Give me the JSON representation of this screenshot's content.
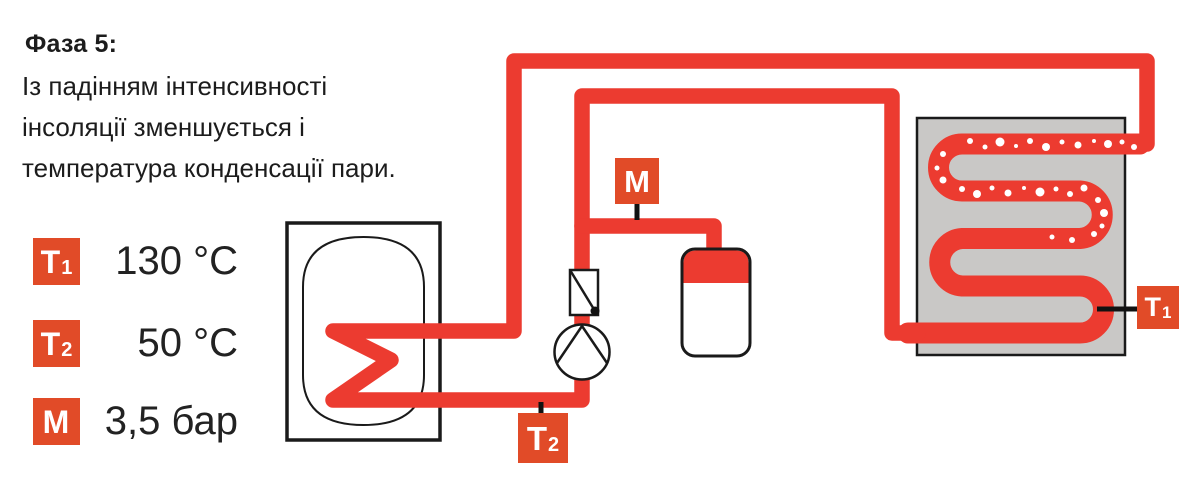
{
  "colors": {
    "pipe_red": "#EC3B30",
    "badge_red": "#E14B28",
    "collector_gray": "#C9C8C6",
    "outline_black": "#1A1A1A",
    "text_black": "#1C1C1C",
    "bubble_white": "#FFFFFF"
  },
  "phase": {
    "title": "Фаза 5:",
    "description_lines": [
      "Із падінням інтенсивності",
      "інсоляції зменшується і",
      "температура конденсації пари."
    ]
  },
  "legend": {
    "rows": [
      {
        "badge": "T",
        "badge_sub": "1",
        "value": "130 °C"
      },
      {
        "badge": "T",
        "badge_sub": "2",
        "value": "50 °C"
      },
      {
        "badge": "M",
        "badge_sub": "",
        "value": "3,5 бар"
      }
    ]
  },
  "diagram": {
    "badges": {
      "m": {
        "label": "M",
        "sub": ""
      },
      "t1": {
        "label": "T",
        "sub": "1"
      },
      "t2": {
        "label": "T",
        "sub": "2"
      }
    },
    "bubbles": [
      [
        970,
        141,
        3
      ],
      [
        985,
        147,
        2.5
      ],
      [
        1000,
        142,
        4.5
      ],
      [
        1016,
        146,
        2
      ],
      [
        1030,
        141,
        3
      ],
      [
        1046,
        147,
        4
      ],
      [
        1062,
        142,
        2.5
      ],
      [
        1078,
        145,
        3.5
      ],
      [
        1094,
        141,
        2
      ],
      [
        1108,
        144,
        4
      ],
      [
        1122,
        142,
        2.5
      ],
      [
        1134,
        147,
        3
      ],
      [
        943,
        154,
        3
      ],
      [
        937,
        168,
        2.5
      ],
      [
        943,
        180,
        3.5
      ],
      [
        962,
        189,
        3
      ],
      [
        977,
        194,
        4
      ],
      [
        992,
        188,
        2.5
      ],
      [
        1008,
        193,
        3.5
      ],
      [
        1024,
        188,
        2
      ],
      [
        1040,
        192,
        4.5
      ],
      [
        1056,
        189,
        2.5
      ],
      [
        1070,
        194,
        3
      ],
      [
        1084,
        188,
        3.5
      ],
      [
        1098,
        200,
        3
      ],
      [
        1104,
        213,
        4
      ],
      [
        1102,
        226,
        2.5
      ],
      [
        1094,
        234,
        3
      ],
      [
        1072,
        240,
        3
      ],
      [
        1052,
        237,
        2.5
      ]
    ]
  }
}
